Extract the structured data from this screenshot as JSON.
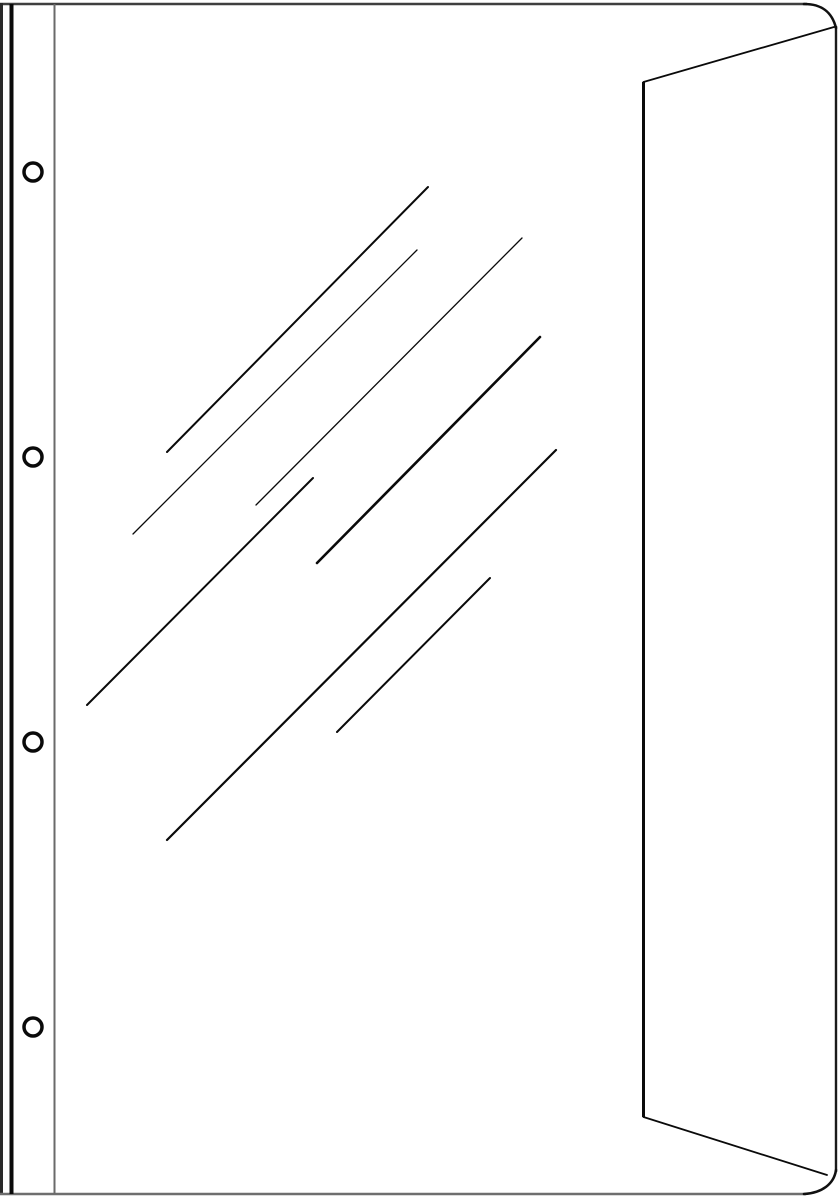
{
  "illustration": {
    "subject": "punched-pocket-sheet-protector-line-drawing",
    "canvas": {
      "width": 840,
      "height": 1200,
      "background": "#ffffff"
    },
    "colors": {
      "ink": "#0a0a0a",
      "border_top": "#3f3f3f",
      "border_bottom": "#6e6e6e",
      "border_left": "#2a2a2a",
      "border_right": "#1a1a1a",
      "strip_inner": "#6a6a6a"
    },
    "strokes": [
      {
        "name": "sheet-top-edge",
        "type": "line",
        "x1": 0,
        "y1": 4,
        "x2": 807,
        "y2": 4,
        "w": 2.6,
        "color": "#3f3f3f",
        "cap": "butt"
      },
      {
        "name": "sheet-left-edge",
        "type": "line",
        "x1": 1.5,
        "y1": 3,
        "x2": 1.5,
        "y2": 1195,
        "w": 3,
        "color": "#2a2a2a",
        "cap": "butt"
      },
      {
        "name": "sheet-bottom-edge",
        "type": "line",
        "x1": 0,
        "y1": 1194,
        "x2": 806,
        "y2": 1194,
        "w": 2.6,
        "color": "#6e6e6e",
        "cap": "butt"
      },
      {
        "name": "sheet-right-edge",
        "type": "line",
        "x1": 836,
        "y1": 26,
        "x2": 836,
        "y2": 1172,
        "w": 2.4,
        "color": "#1a1a1a",
        "cap": "butt"
      },
      {
        "name": "binding-strip-outer-line",
        "type": "line",
        "x1": 11.5,
        "y1": 4,
        "x2": 11.5,
        "y2": 1194,
        "w": 4,
        "color": "#0a0a0a",
        "cap": "butt"
      },
      {
        "name": "binding-strip-inner-line",
        "type": "line",
        "x1": 54.5,
        "y1": 4,
        "x2": 54.5,
        "y2": 1194,
        "w": 2,
        "color": "#6a6a6a",
        "cap": "butt"
      },
      {
        "name": "flap-fold-line",
        "type": "line",
        "x1": 643.5,
        "y1": 82,
        "x2": 643.5,
        "y2": 1117,
        "w": 3,
        "color": "#0a0a0a",
        "cap": "butt"
      },
      {
        "name": "flap-top-diagonal",
        "type": "line",
        "x1": 643.5,
        "y1": 82,
        "x2": 834,
        "y2": 27,
        "w": 1.8,
        "color": "#0a0a0a",
        "cap": "round"
      },
      {
        "name": "flap-bottom-diagonal",
        "type": "line",
        "x1": 643.5,
        "y1": 1117,
        "x2": 827,
        "y2": 1175,
        "w": 1.8,
        "color": "#0a0a0a",
        "cap": "round"
      },
      {
        "name": "top-right-corner-curve",
        "type": "path",
        "d": "M 804 4 C 822 4 832 12 836 28",
        "w": 2.6,
        "color": "#111111"
      },
      {
        "name": "bottom-right-corner-curve",
        "type": "path",
        "d": "M 836 1170 C 834 1184 822 1193 804 1194",
        "w": 2.6,
        "color": "#111111"
      }
    ],
    "punch_holes": {
      "cx": 33,
      "r": 9,
      "stroke_w": 3.5,
      "color": "#0a0a0a",
      "fill": "#ffffff",
      "cys": [
        172,
        457,
        742,
        1027
      ]
    },
    "shine_lines": [
      {
        "name": "shine-line-1",
        "x1": 167,
        "y1": 452,
        "x2": 428,
        "y2": 187,
        "w": 2.0
      },
      {
        "name": "shine-line-2",
        "x1": 133,
        "y1": 534,
        "x2": 417,
        "y2": 250,
        "w": 1.3
      },
      {
        "name": "shine-line-3",
        "x1": 256,
        "y1": 505,
        "x2": 522,
        "y2": 238,
        "w": 1.3
      },
      {
        "name": "shine-line-4",
        "x1": 317,
        "y1": 563,
        "x2": 540,
        "y2": 337,
        "w": 2.6
      },
      {
        "name": "shine-line-5",
        "x1": 87,
        "y1": 705,
        "x2": 313,
        "y2": 478,
        "w": 2.0
      },
      {
        "name": "shine-line-6",
        "x1": 167,
        "y1": 840,
        "x2": 556,
        "y2": 450,
        "w": 2.2
      },
      {
        "name": "shine-line-7",
        "x1": 337,
        "y1": 732,
        "x2": 490,
        "y2": 578,
        "w": 2.0
      }
    ]
  }
}
